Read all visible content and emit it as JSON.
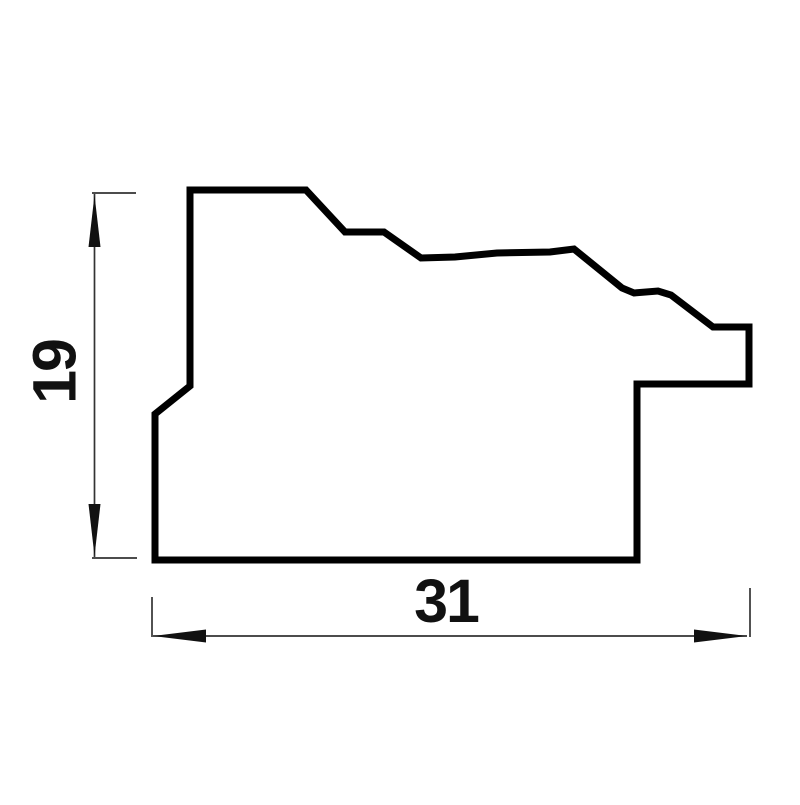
{
  "page": {
    "background_color": "#ffffff"
  },
  "drawing": {
    "description": "moulding-profile-cross-section",
    "canvas": {
      "width": 800,
      "height": 800
    },
    "outline": {
      "color": "#000000",
      "stroke_width": 7,
      "points": [
        [
          190,
          190
        ],
        [
          306,
          190
        ],
        [
          345,
          232
        ],
        [
          384,
          232
        ],
        [
          421,
          258
        ],
        [
          455,
          257
        ],
        [
          497,
          253
        ],
        [
          550,
          252
        ],
        [
          574,
          249
        ],
        [
          622,
          288
        ],
        [
          634,
          293
        ],
        [
          658,
          291
        ],
        [
          671,
          295
        ],
        [
          713,
          327
        ],
        [
          749,
          327
        ],
        [
          749,
          384
        ],
        [
          637,
          384
        ],
        [
          637,
          560
        ],
        [
          155,
          560
        ],
        [
          155,
          414
        ],
        [
          190,
          386
        ]
      ]
    },
    "dimensions": {
      "line_color": "#333333",
      "arrow_color": "#111111",
      "text_color": "#111111",
      "stroke_width": 1.7,
      "height": {
        "value": "19",
        "line": {
          "x": 94.5,
          "y1": 194,
          "y2": 557
        },
        "extension_top": {
          "y": 193,
          "x1": 92,
          "x2": 136
        },
        "extension_bottom": {
          "y": 558,
          "x1": 92,
          "x2": 137
        },
        "arrow_up": "94.5,195 88.5,247 100.5,247",
        "arrow_down": "94.5,556 88.5,504 100.5,504",
        "label_x": 54,
        "label_y": 372,
        "font_size": 61
      },
      "width": {
        "value": "31",
        "line": {
          "y": 636,
          "x1": 153,
          "x2": 747
        },
        "extension_left": {
          "x": 152,
          "y1": 597,
          "y2": 637
        },
        "extension_right": {
          "x": 750,
          "y1": 588,
          "y2": 637
        },
        "arrow_left": "153,636 206,629.5 206,642.5",
        "arrow_right": "747,636 694,629.5 694,642.5",
        "label_x": 446,
        "label_y": 622,
        "font_size": 61
      }
    }
  }
}
